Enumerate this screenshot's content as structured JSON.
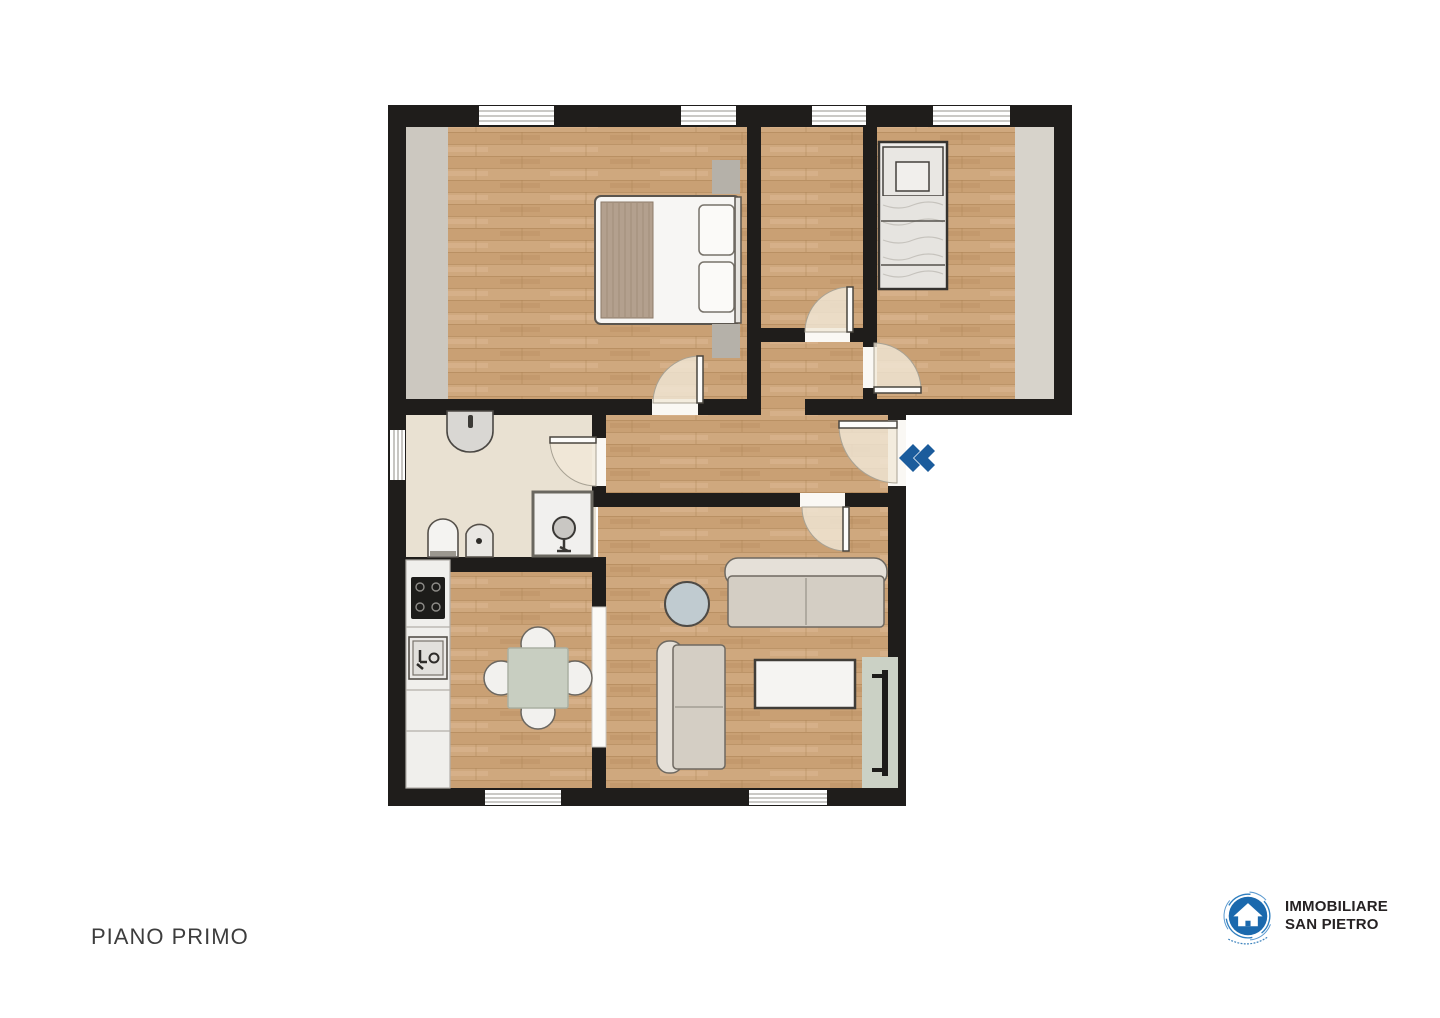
{
  "page": {
    "background": "#ffffff"
  },
  "floor_plan": {
    "label": "PIANO PRIMO",
    "rooms": [
      "master-bedroom",
      "middle-room",
      "single-bedroom",
      "hallway",
      "bathroom",
      "kitchen",
      "living-room"
    ],
    "entry_arrow_icon": "double-chevron-left",
    "colors": {
      "wall": "#1f1d1b",
      "wood_floor": "#cfa87e",
      "bathroom_floor": "#e9e1d2",
      "wardrobe_strip": "#ccc8c0",
      "radiator_niche": "#cbd1c5",
      "entry_arrow": "#1b5c9c",
      "door_swing": "#f1e9d8"
    }
  },
  "logo": {
    "name1": "IMMOBILIARE",
    "name2": "SAN PIETRO",
    "brand_blue": "#1b69ad",
    "icon": "house-in-circle"
  }
}
